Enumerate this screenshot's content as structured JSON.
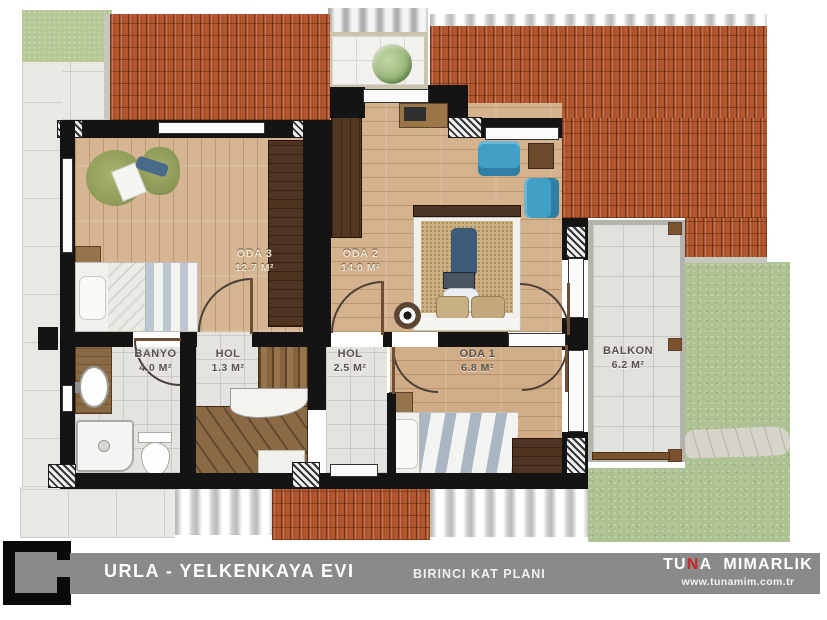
{
  "plan": {
    "rooms": [
      {
        "id": "oda3",
        "name": "ODA 3",
        "area": "12.7 M²"
      },
      {
        "id": "oda2",
        "name": "ODA 2",
        "area": "14.0 M²"
      },
      {
        "id": "oda1",
        "name": "ODA 1",
        "area": "6.8 M²"
      },
      {
        "id": "banyo",
        "name": "BANYO",
        "area": "4.0 M²"
      },
      {
        "id": "hol-1",
        "name": "HOL",
        "area": "1.3 M²"
      },
      {
        "id": "hol-2",
        "name": "HOL",
        "area": "2.5 M²"
      },
      {
        "id": "balkon",
        "name": "BALKON",
        "area": "6.2 M²"
      }
    ]
  },
  "footer": {
    "project_title": "URLA - YELKENKAYA EVI",
    "plan_label": "BIRINCI KAT PLANI",
    "brand": {
      "pre": "TU",
      "accent": "N",
      "post": "A",
      "word2": "MIMARLIK"
    },
    "website": "www.tunamim.com.tr"
  },
  "colors": {
    "roof_tile": "#b3572f",
    "grass": "#adc192",
    "wood_floor": "#d3b28d",
    "wall": "#141414",
    "footer_bar": "#8a8a8a",
    "brand_accent": "#c62828",
    "balcony_tile": "#e3e1dd",
    "stair_wood": "#8a6a45",
    "chair_blue": "#3f9fc7",
    "armchair_olive": "#8f9c59"
  }
}
